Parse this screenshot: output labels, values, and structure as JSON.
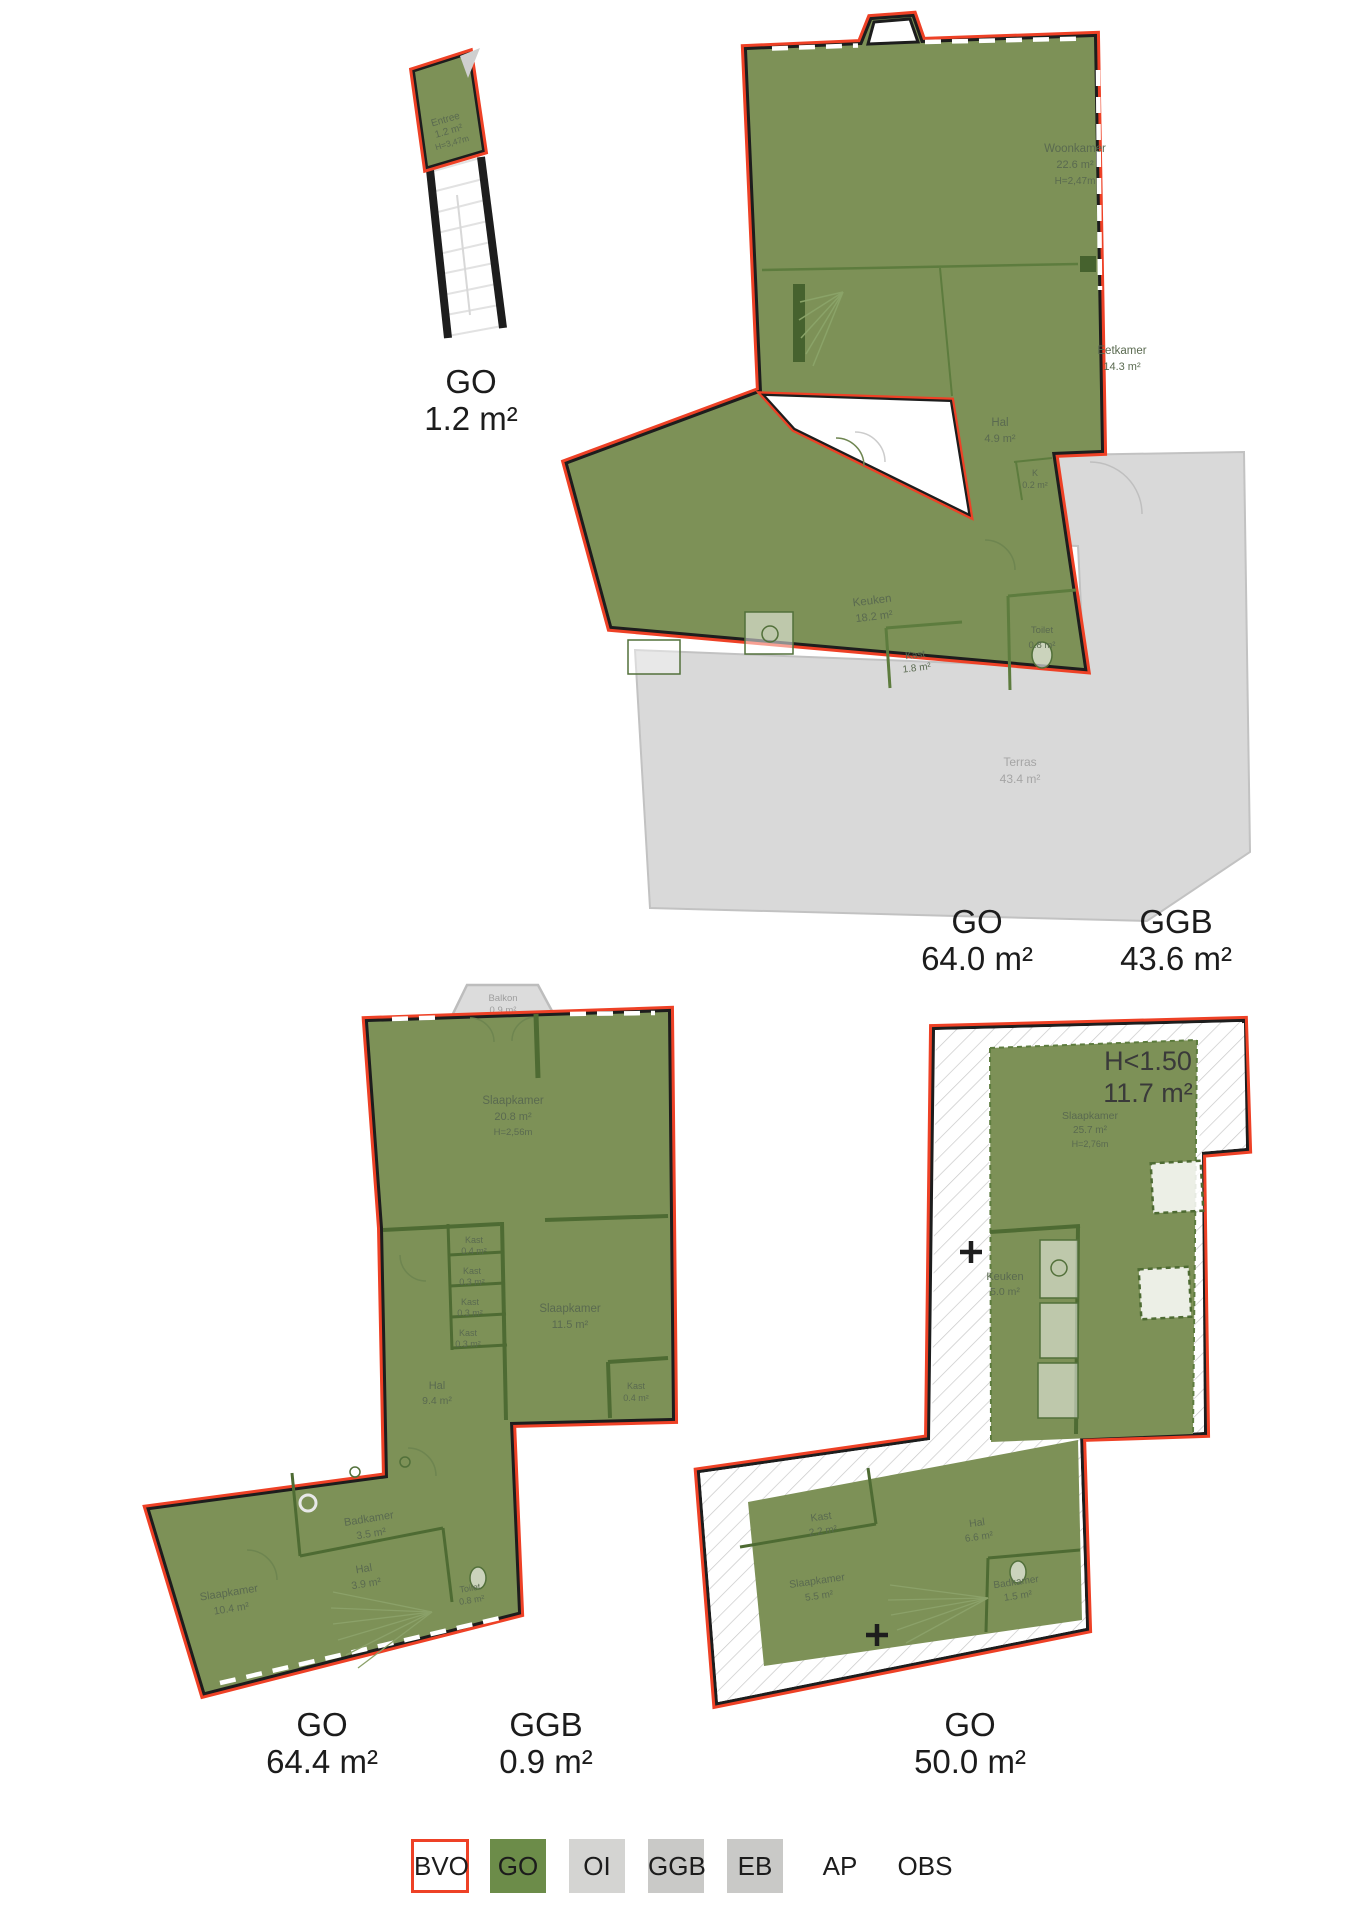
{
  "colors": {
    "bvo_red": "#ee4126",
    "go_green": "#7d9157",
    "wall_black": "#1d1d1d",
    "ggb_gray": "#d9d9d9",
    "legend_oi_gray": "#d4d4d2",
    "legend_ggb_gray": "#c9c9c7",
    "room_text": "#5a6a50"
  },
  "plans": {
    "entree": {
      "rooms": {
        "entree": {
          "name": "Entree",
          "area": "1.2 m²",
          "height": "H=3,47m"
        }
      },
      "totals": [
        {
          "label": "GO",
          "value": "1.2 m²"
        }
      ]
    },
    "living": {
      "rooms": {
        "woonkamer": {
          "name": "Woonkamer",
          "area": "22.6 m²",
          "height": "H=2,47m"
        },
        "eetkamer": {
          "name": "Eetkamer",
          "area": "14.3 m²"
        },
        "hal": {
          "name": "Hal",
          "area": "4.9 m²"
        },
        "kast_k": {
          "name": "K",
          "area": "0.2 m²"
        },
        "keuken": {
          "name": "Keuken",
          "area": "18.2 m²"
        },
        "kast": {
          "name": "Kast",
          "area": "1.8 m²"
        },
        "toilet": {
          "name": "Toilet",
          "area": "0.8 m²"
        },
        "terras": {
          "name": "Terras",
          "area": "43.4 m²"
        }
      },
      "totals": [
        {
          "label": "GO",
          "value": "64.0 m²"
        },
        {
          "label": "GGB",
          "value": "43.6 m²"
        }
      ]
    },
    "bedrooms": {
      "rooms": {
        "balkon": {
          "name": "Balkon",
          "area": "0.9 m²"
        },
        "slaapkamer1": {
          "name": "Slaapkamer",
          "area": "20.8 m²",
          "height": "H=2,56m"
        },
        "kast1": {
          "name": "Kast",
          "area": "0.4 m²"
        },
        "kast2": {
          "name": "Kast",
          "area": "0.3 m²"
        },
        "kast3": {
          "name": "Kast",
          "area": "0.3 m²"
        },
        "kast4": {
          "name": "Kast",
          "area": "0.3 m²"
        },
        "slaapkamer2": {
          "name": "Slaapkamer",
          "area": "11.5 m²"
        },
        "kast5": {
          "name": "Kast",
          "area": "0.4 m²"
        },
        "hal1": {
          "name": "Hal",
          "area": "9.4 m²"
        },
        "badkamer": {
          "name": "Badkamer",
          "area": "3.5 m²"
        },
        "hal2": {
          "name": "Hal",
          "area": "3.9 m²"
        },
        "toilet": {
          "name": "Toilet",
          "area": "0.8 m²"
        },
        "slaapkamer3": {
          "name": "Slaapkamer",
          "area": "10.4 m²"
        }
      },
      "totals": [
        {
          "label": "GO",
          "value": "64.4 m²"
        },
        {
          "label": "GGB",
          "value": "0.9 m²"
        }
      ]
    },
    "attic": {
      "h_label": {
        "line1": "H<1.50",
        "line2": "11.7 m²"
      },
      "rooms": {
        "slaapkamer1": {
          "name": "Slaapkamer",
          "area": "25.7 m²",
          "height": "H=2,76m"
        },
        "keuken": {
          "name": "Keuken",
          "area": "5.0 m²"
        },
        "kast": {
          "name": "Kast",
          "area": "2.2 m²"
        },
        "hal": {
          "name": "Hal",
          "area": "6.6 m²"
        },
        "slaapkamer2": {
          "name": "Slaapkamer",
          "area": "5.5 m²"
        },
        "badkamer": {
          "name": "Badkamer",
          "area": "1.5 m²"
        }
      },
      "totals": [
        {
          "label": "GO",
          "value": "50.0 m²"
        }
      ]
    }
  },
  "legend": {
    "items": [
      {
        "label": "BVO"
      },
      {
        "label": "GO"
      },
      {
        "label": "OI"
      },
      {
        "label": "GGB"
      },
      {
        "label": "EB"
      },
      {
        "label": "AP"
      },
      {
        "label": "OBS"
      }
    ]
  }
}
